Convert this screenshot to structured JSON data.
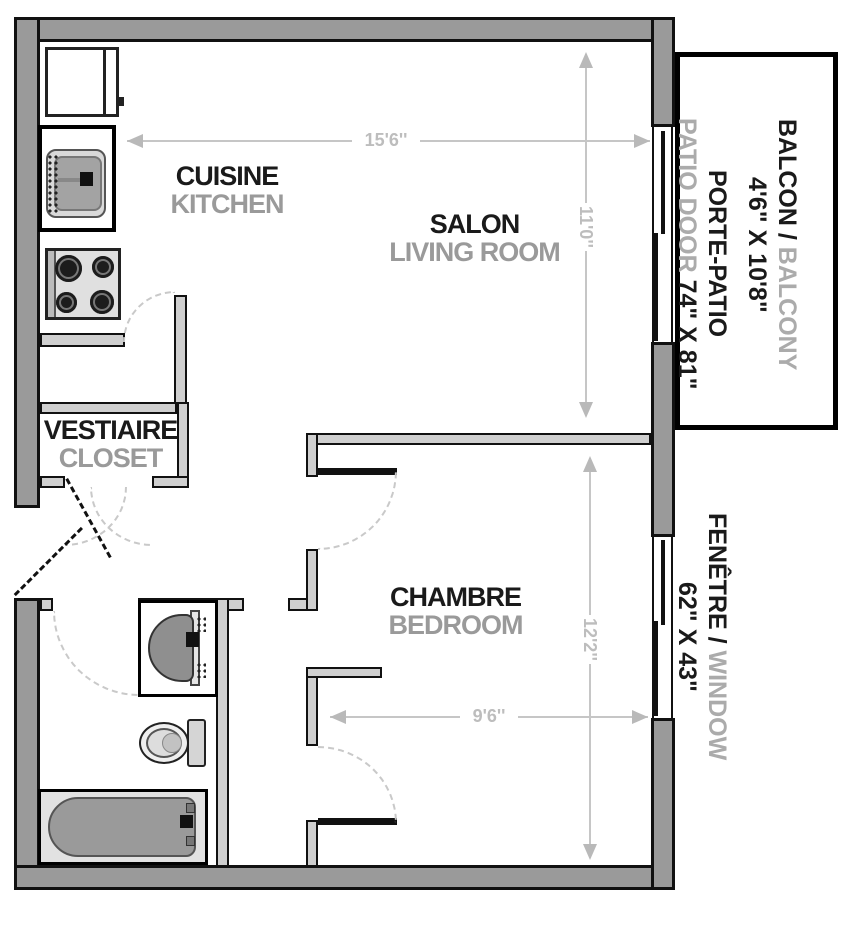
{
  "rooms": {
    "kitchen": {
      "name_fr": "CUISINE",
      "name_en": "KITCHEN"
    },
    "living_room": {
      "name_fr": "SALON",
      "name_en": "LIVING ROOM"
    },
    "closet": {
      "name_fr": "VESTIAIRE",
      "name_en": "CLOSET"
    },
    "bedroom": {
      "name_fr": "CHAMBRE",
      "name_en": "BEDROOM"
    }
  },
  "side_labels": {
    "balcony": {
      "fr": "BALCON / ",
      "en": "BALCONY",
      "size": "4'6\" X 10'8\""
    },
    "patio_door": {
      "fr": "PORTE-PATIO",
      "en": "PATIO DOOR ",
      "size": "74\" X 81\""
    },
    "window": {
      "fr": "FENÊTRE / ",
      "en": "WINDOW",
      "size": "62\" X 43\""
    }
  },
  "dimensions": {
    "living_width": "15'6''",
    "living_depth": "11'0''",
    "bedroom_depth": "12'2''",
    "bedroom_width": "9'6''"
  },
  "colors": {
    "exterior_wall": "#9a9a9a",
    "partition_wall": "#cfcfcf",
    "dimension_gray": "#c6c6c6",
    "secondary_label_gray": "#9a9a9a",
    "primary_label_black": "#1a1a1a"
  }
}
